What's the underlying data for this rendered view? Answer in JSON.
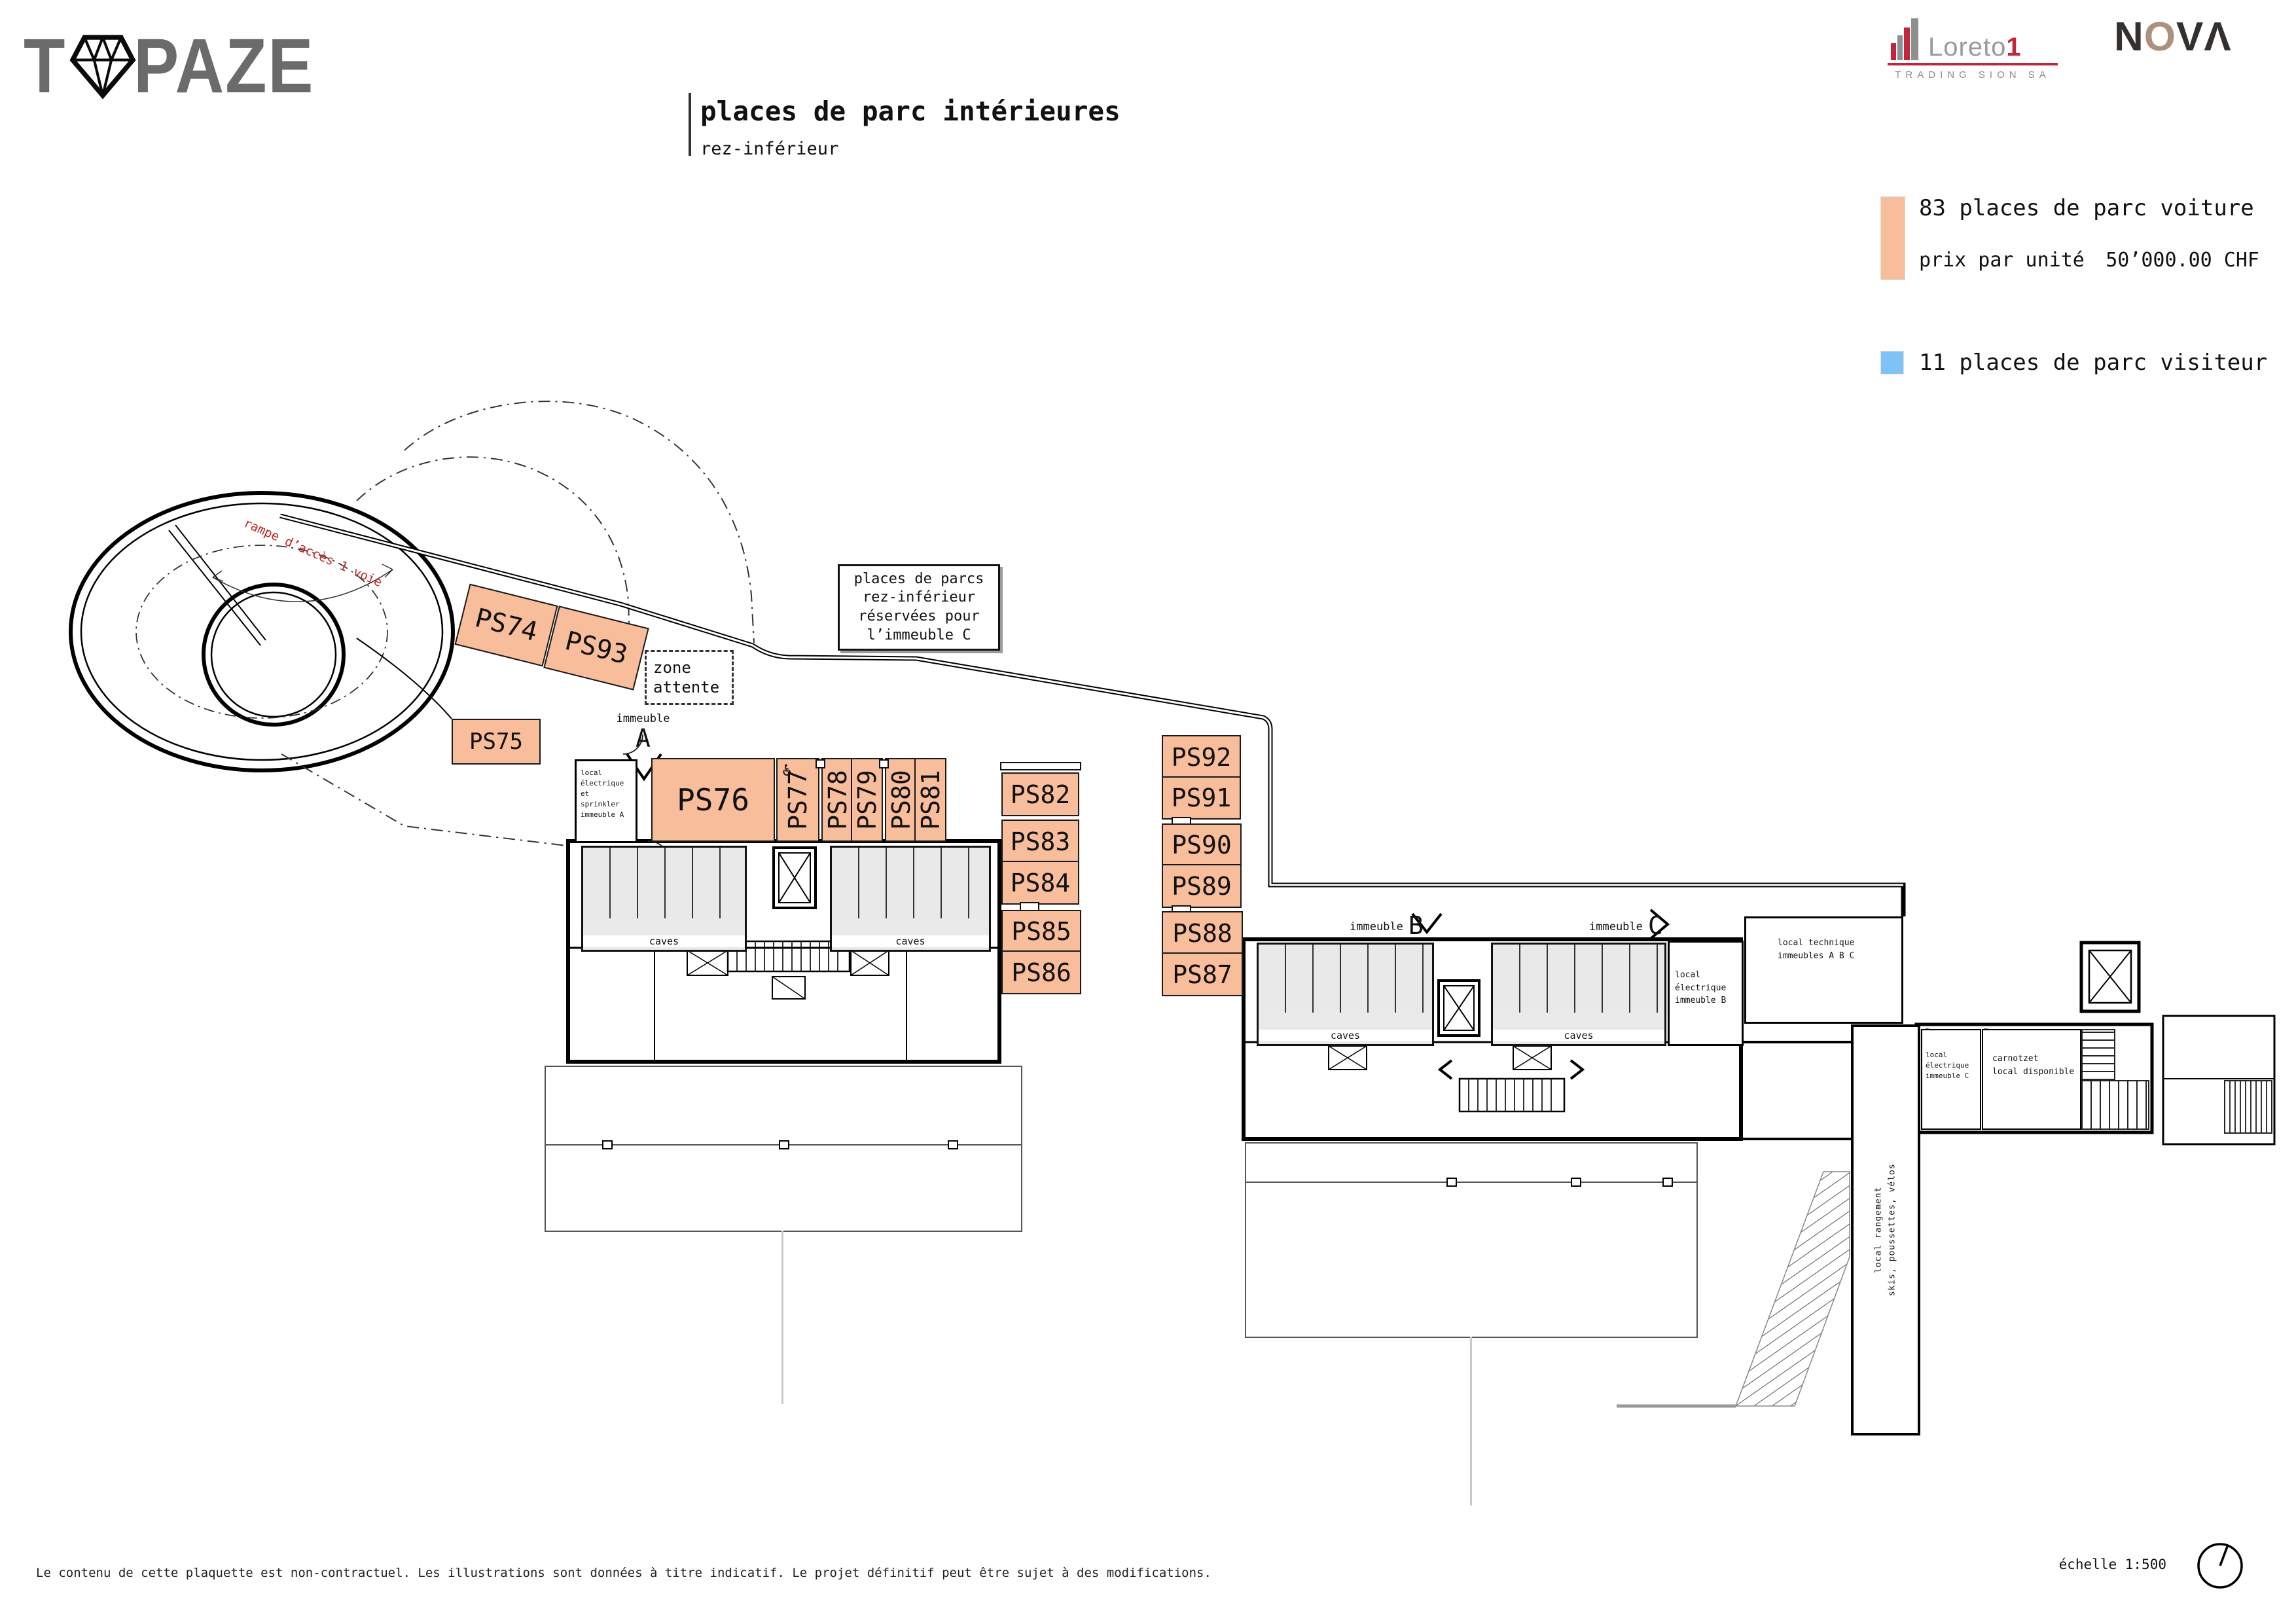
{
  "header": {
    "brand": {
      "t": "T",
      "paze": "PAZE"
    },
    "title": "places de parc intérieures",
    "subtitle": "rez-inférieur",
    "loreto": {
      "name": "Loreto",
      "one": "1",
      "tagline": "TRADING SION SA"
    },
    "nova": {
      "n": "N",
      "o": "O",
      "va": "VΛ"
    }
  },
  "legend": {
    "car_count": "83 places de parc voiture",
    "price_label": "prix par unité",
    "price_value": "50’000.00 CHF",
    "car_color": "#f8bd9a",
    "visitor_count": "11 places de parc visiteur",
    "visitor_color": "#7fc2f5"
  },
  "plan": {
    "ramp_label": "rampe d’accès 1 voie",
    "note_box": "places de parcs\nrez-inférieur\nréservées pour\nl’immeuble C",
    "zone_attente": "zone\nattente",
    "caves": "caves",
    "immeuble_word": "immeuble",
    "letters": {
      "a": "A",
      "b": "B",
      "c": "C"
    },
    "rooms": {
      "sprinkler_a": "local électrique et\nsprinkler\nimmeuble A",
      "electrique_b": "local électrique\nimmeuble B",
      "technique_abc": "local technique\nimmeubles A B C",
      "electrique_c": "local électrique\nimmeuble C",
      "carnotzet": "carnotzet\nlocal disponible",
      "rangement": "local rangement\nskis, poussettes, vélos"
    },
    "accessible_icon": "♿",
    "spaces": {
      "ps74": "PS74",
      "ps75": "PS75",
      "ps76": "PS76",
      "ps77": "PS77",
      "ps78": "PS78",
      "ps79": "PS79",
      "ps80": "PS80",
      "ps81": "PS81",
      "ps82": "PS82",
      "ps83": "PS83",
      "ps84": "PS84",
      "ps85": "PS85",
      "ps86": "PS86",
      "ps87": "PS87",
      "ps88": "PS88",
      "ps89": "PS89",
      "ps90": "PS90",
      "ps91": "PS91",
      "ps92": "PS92",
      "ps93": "PS93"
    }
  },
  "footer": {
    "disclaimer": "Le contenu de cette plaquette est non-contractuel. Les illustrations sont données à titre indicatif. Le projet définitif peut être sujet à des modifications.",
    "scale": "échelle 1:500"
  }
}
